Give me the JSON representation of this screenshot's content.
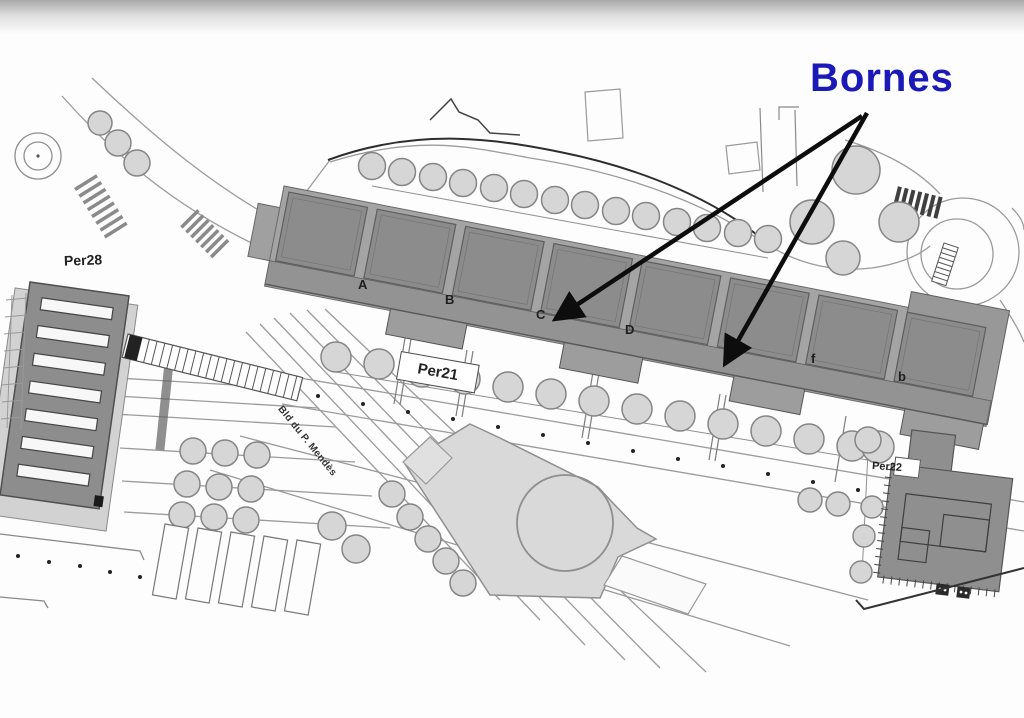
{
  "annotation": {
    "title": "Bornes",
    "title_color": "#1b1ab8",
    "arrow_color": "#0d0d0d",
    "arrow_count": 2
  },
  "plan": {
    "platforms": {
      "per28": "Per28",
      "per21": "Per21",
      "per22": "Per22"
    },
    "zones": [
      "A",
      "B",
      "C",
      "D",
      "f",
      "b"
    ],
    "street": "Bld du P. Mendès"
  },
  "colors": {
    "canopy_dark": "#8c8c8c",
    "canopy_base": "#a4a4a4",
    "building_light": "#d9d9d9",
    "tree_fill": "#d6d6d6",
    "plan_line": "#9b9b9b",
    "dark_line": "#2e2e2e"
  }
}
